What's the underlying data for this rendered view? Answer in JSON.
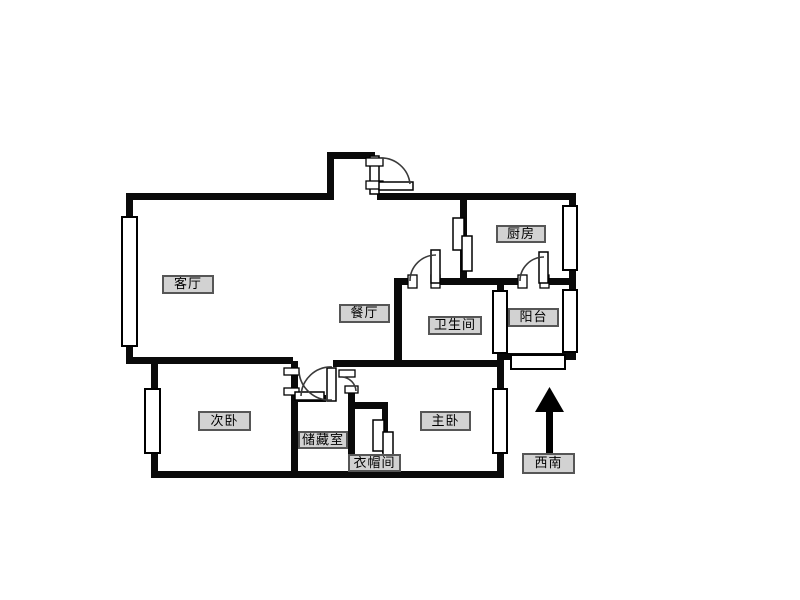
{
  "document": {
    "kind": "apartment-floor-plan"
  },
  "colors": {
    "background": "#ffffff",
    "wall": "#0a0a0a",
    "label_background": "#d2d2d2",
    "label_border": "#565656",
    "label_text": "#000000",
    "compass_arrow": "#000000"
  },
  "rooms": [
    {
      "id": "living-room",
      "label": "客厅"
    },
    {
      "id": "dining-room",
      "label": "餐厅"
    },
    {
      "id": "kitchen",
      "label": "厨房"
    },
    {
      "id": "bathroom",
      "label": "卫生间"
    },
    {
      "id": "balcony",
      "label": "阳台"
    },
    {
      "id": "second-bedroom",
      "label": "次卧"
    },
    {
      "id": "storage-room",
      "label": "储藏室"
    },
    {
      "id": "cloakroom",
      "label": "衣帽间"
    },
    {
      "id": "master-bedroom",
      "label": "主卧"
    }
  ],
  "compass": {
    "direction_label": "西南",
    "arrow_direction": "up"
  }
}
